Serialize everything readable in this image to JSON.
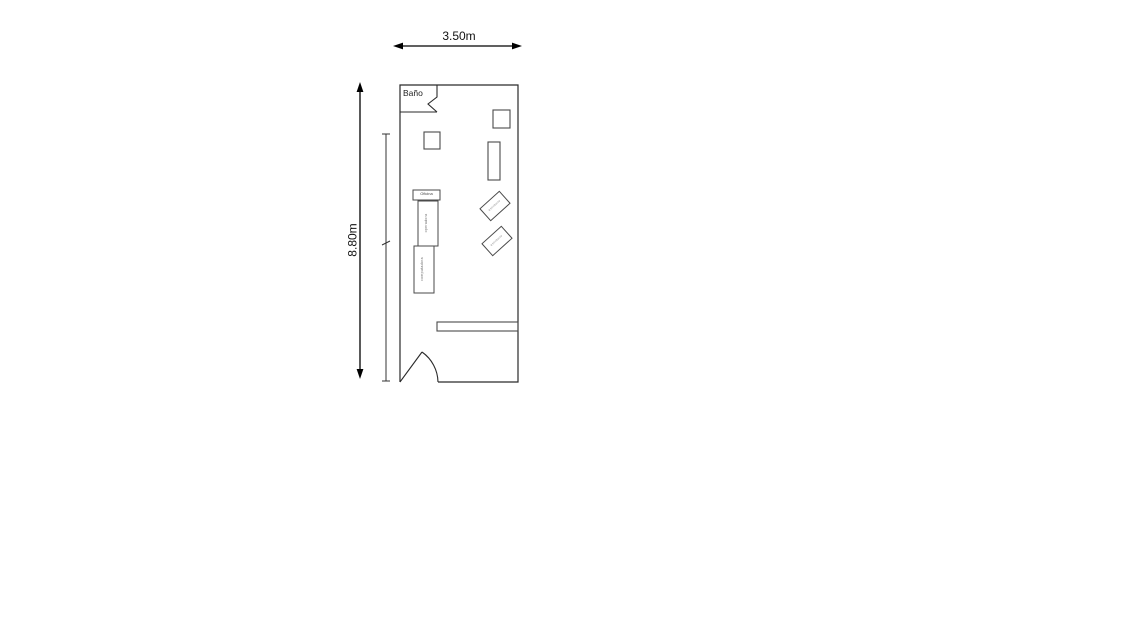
{
  "floor_plan": {
    "type": "floor-plan",
    "dimensions": {
      "width_label": "3.50m",
      "height_label": "8.80m"
    },
    "rooms": {
      "bathroom_label": "Baño",
      "office_label": "Oficina"
    },
    "furniture": {
      "vertical_desk_1_label": "operadora",
      "vertical_desk_2_label": "computadora",
      "diagonal_desk_1_label": "escritorio",
      "diagonal_desk_2_label": "escritorio"
    },
    "colors": {
      "wall": "#2a2a2a",
      "dimension_line": "#000000",
      "furniture_line": "#4a4a4a",
      "tiny_text": "#777777",
      "background": "#ffffff"
    }
  }
}
